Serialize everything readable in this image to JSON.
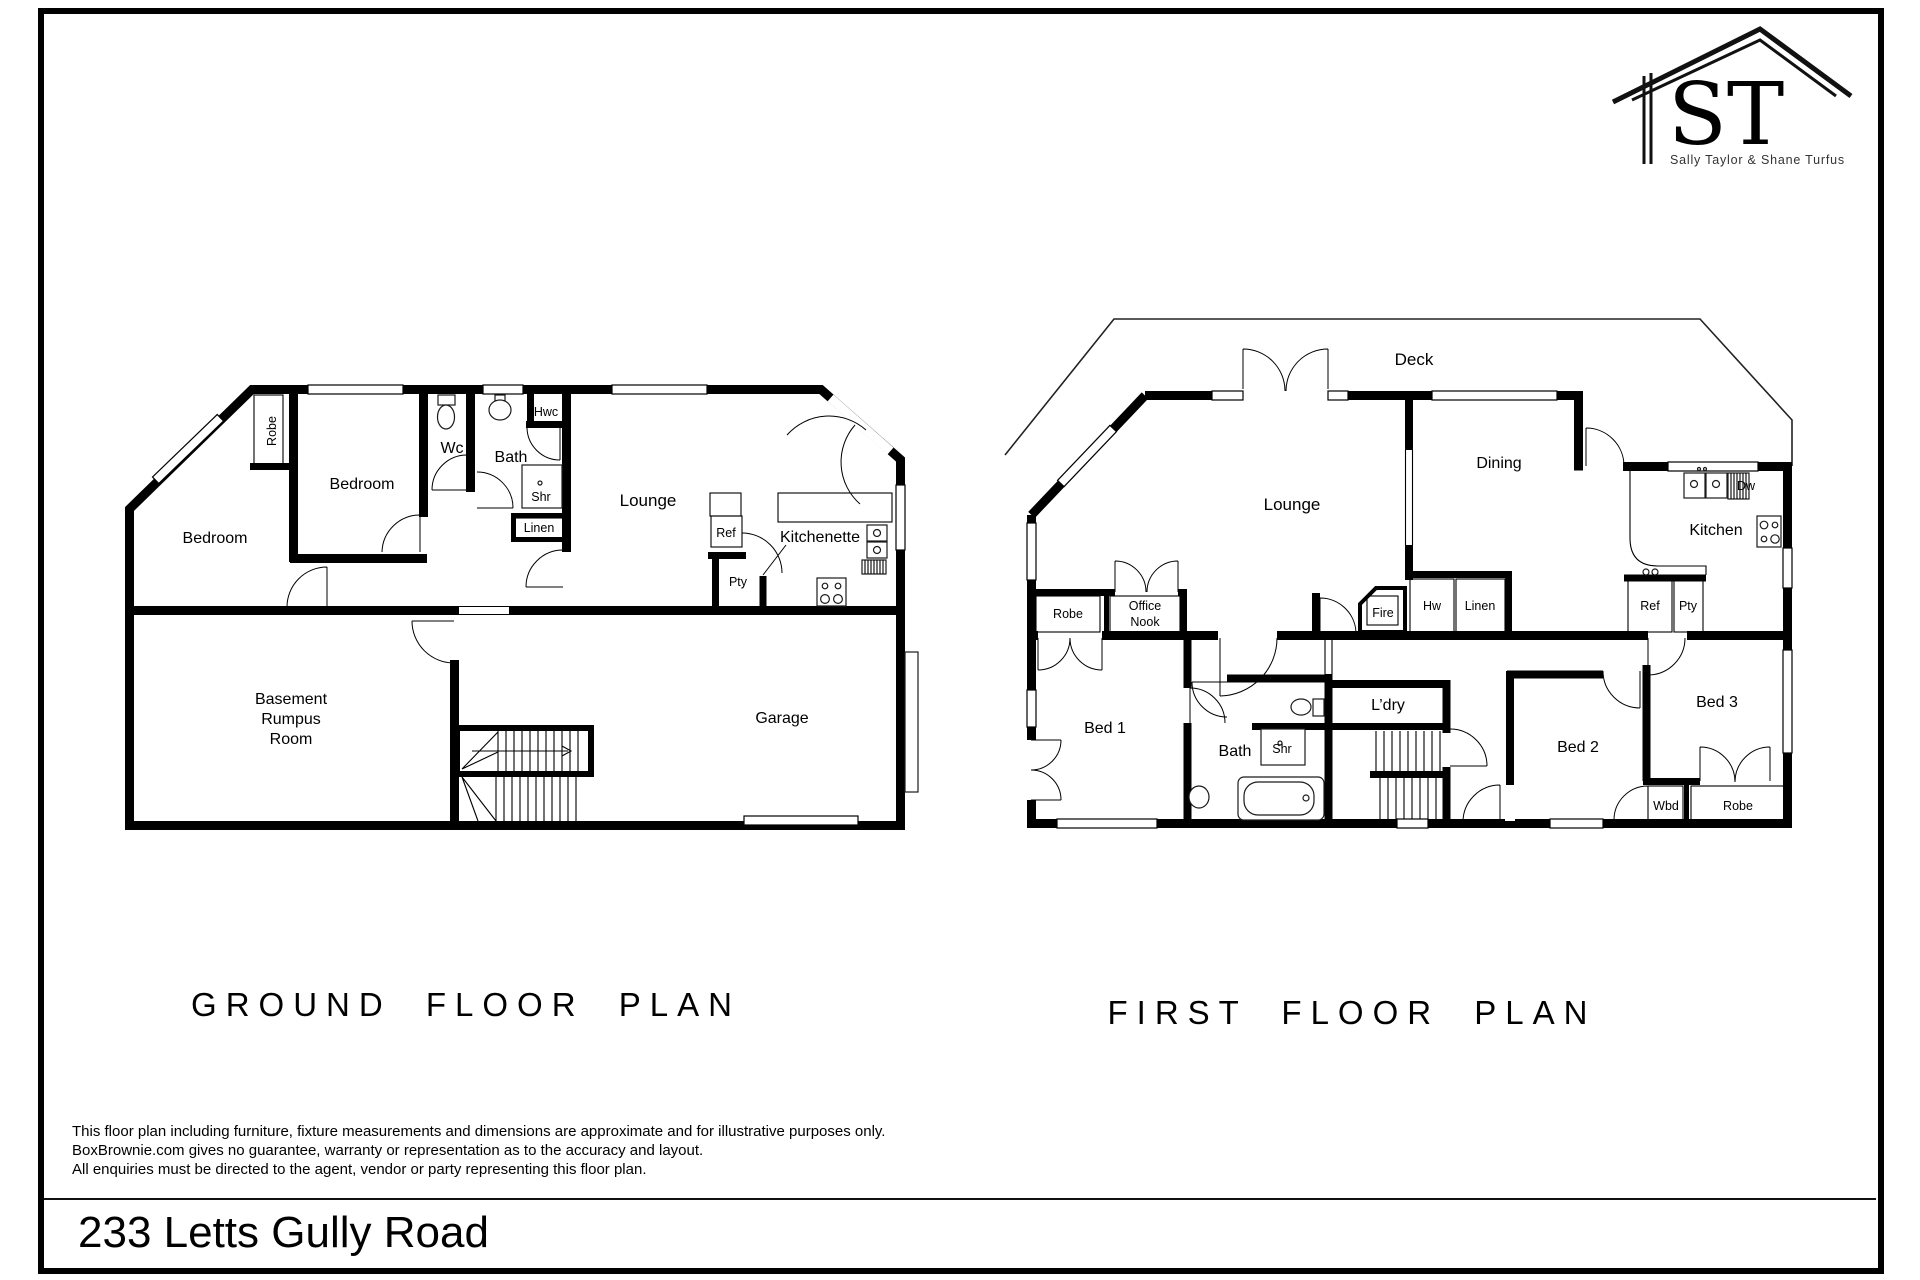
{
  "logo": {
    "initials": "ST",
    "subtitle": "Sally Taylor & Shane Turfus"
  },
  "ground_floor": {
    "title": "GROUND FLOOR PLAN",
    "rooms": {
      "robe": "Robe",
      "bedroom_upper": "Bedroom",
      "bedroom_left": "Bedroom",
      "wc": "Wc",
      "bath": "Bath",
      "hwc": "Hwc",
      "shr": "Shr",
      "linen": "Linen",
      "lounge": "Lounge",
      "ref": "Ref",
      "kitchenette": "Kitchenette",
      "pty": "Pty",
      "basement_l1": "Basement",
      "basement_l2": "Rumpus",
      "basement_l3": "Room",
      "garage": "Garage"
    }
  },
  "first_floor": {
    "title": "FIRST FLOOR PLAN",
    "rooms": {
      "deck": "Deck",
      "lounge": "Lounge",
      "dining": "Dining",
      "kitchen": "Kitchen",
      "dw": "Dw",
      "robe": "Robe",
      "office_l1": "Office",
      "office_l2": "Nook",
      "fire": "Fire",
      "hw": "Hw",
      "linen": "Linen",
      "ref": "Ref",
      "pty": "Pty",
      "bed1": "Bed 1",
      "bath": "Bath",
      "shr": "Shr",
      "ldry": "L’dry",
      "bed2": "Bed 2",
      "bed3": "Bed 3",
      "wbd": "Wbd",
      "robe2": "Robe"
    }
  },
  "disclaimer": {
    "line1": "This floor plan including furniture, fixture measurements and dimensions are approximate and for illustrative purposes only.",
    "line2": "BoxBrownie.com gives no guarantee, warranty or representation as to the accuracy and layout.",
    "line3": "All enquiries must be directed to the agent, vendor or party representing this floor plan."
  },
  "footer": {
    "address": "233 Letts Gully Road"
  }
}
